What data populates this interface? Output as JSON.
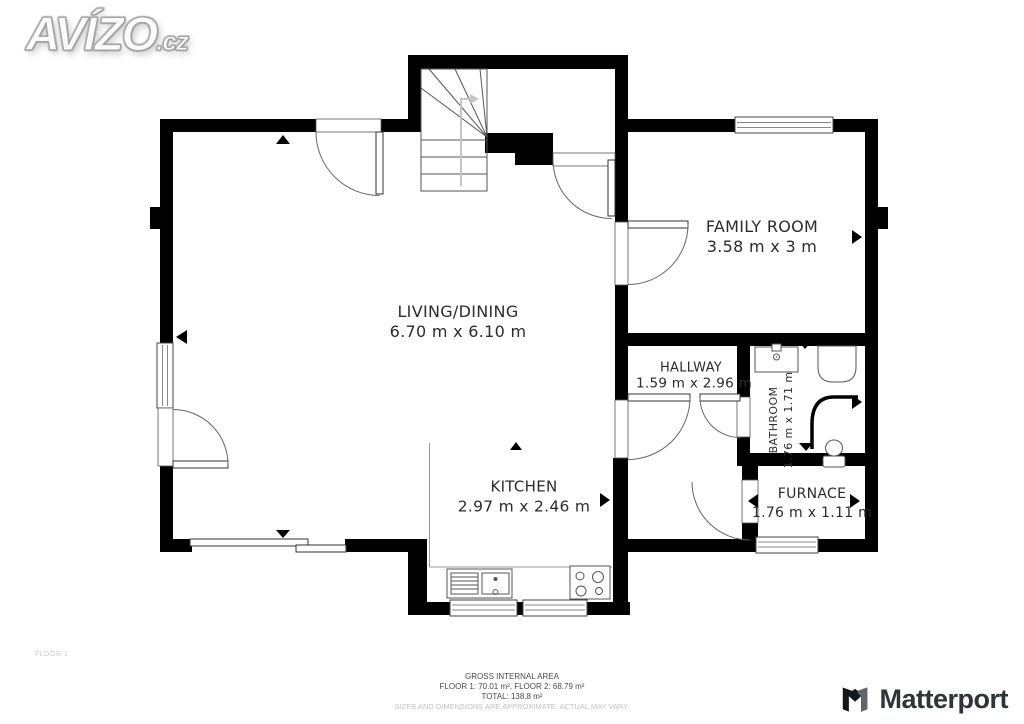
{
  "branding": {
    "site_logo": "AVÍZO",
    "site_logo_suffix": ".cz",
    "provider_logo": "Matterport"
  },
  "floor_label": "FLOOR 1",
  "rooms": [
    {
      "name": "LIVING/DINING",
      "dimensions": "6.70 m x 6.10 m"
    },
    {
      "name": "FAMILY ROOM",
      "dimensions": "3.58 m x 3 m"
    },
    {
      "name": "HALLWAY",
      "dimensions": "1.59 m x 2.96 m"
    },
    {
      "name": "BATHROOM",
      "dimensions": "1.76 m x 1.71 m"
    },
    {
      "name": "KITCHEN",
      "dimensions": "2.97 m x 2.46 m"
    },
    {
      "name": "FURNACE",
      "dimensions": "1.76 m x 1.11 m"
    }
  ],
  "footer": {
    "title": "GROSS INTERNAL AREA",
    "floors": "FLOOR 1: 70.01 m², FLOOR 2: 68.79 m²",
    "total": "TOTAL: 138.8 m²",
    "disclaimer": "SIZES AND DIMENSIONS ARE APPROXIMATE, ACTUAL MAY VARY."
  },
  "colors": {
    "wall": "#000000",
    "background": "#ffffff",
    "label_text": "#2b2b2b",
    "muted_text": "#c2c2c2"
  }
}
